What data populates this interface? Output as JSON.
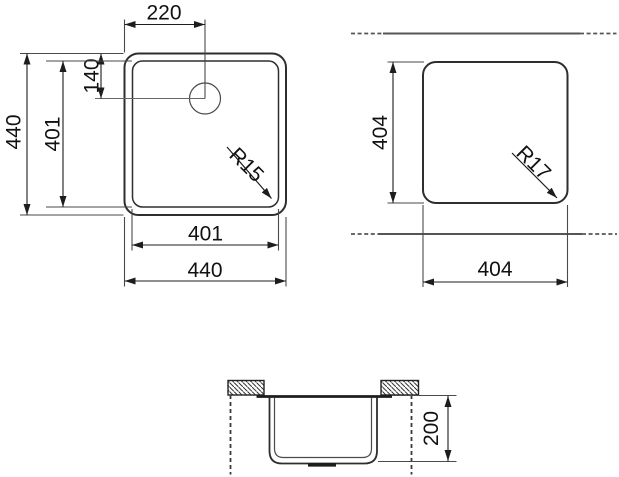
{
  "views": {
    "top_view": {
      "outer_width": "440",
      "outer_height": "440",
      "inner_width": "401",
      "inner_height": "401",
      "tap_hole_offset_x": "220",
      "tap_hole_offset_y": "140",
      "corner_radius": "R15"
    },
    "cutout_view": {
      "width": "404",
      "height": "404",
      "corner_radius": "R17"
    },
    "section_view": {
      "depth": "200"
    }
  }
}
